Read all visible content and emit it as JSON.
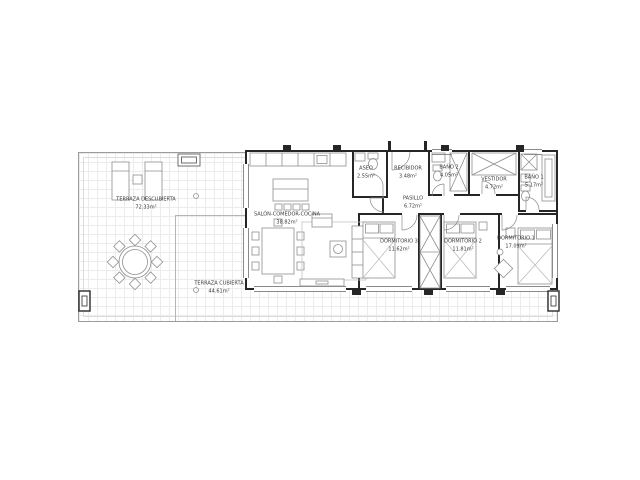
{
  "floor_plan": {
    "type": "architectural-floor-plan",
    "language": "es",
    "rooms": {
      "terraza_descubierta": {
        "label": "TERRAZA DESCUBIERTA",
        "area": "72.33m²"
      },
      "terraza_cubierta": {
        "label": "TERRAZA CUBIERTA",
        "area": "44.61m²"
      },
      "salon": {
        "label": "SALÓN-COMEDOR-COCINA",
        "area": "38.82m²"
      },
      "aseo": {
        "label": "ASEO",
        "area": "2.55m²"
      },
      "recibidor": {
        "label": "RECIBIDOR",
        "area": "3.48m²"
      },
      "pasillo": {
        "label": "PASILLO",
        "area": "6.72m²"
      },
      "bano_2": {
        "label": "BAÑO 2",
        "area": "4.05m²"
      },
      "vestidor": {
        "label": "VESTIDOR",
        "area": "4.72m²"
      },
      "bano_1": {
        "label": "BAÑO 1",
        "area": "5.17m²"
      },
      "dormitorio_3": {
        "label": "DORMITORIO 3",
        "area": "11.62m²"
      },
      "dormitorio_2": {
        "label": "DORMITORIO 2",
        "area": "11.81m²"
      },
      "dormitorio_1": {
        "label": "DORMITORIO 1",
        "area": "17.09m²"
      }
    },
    "colors": {
      "wall": "#262626",
      "furniture_line": "#8f8f8f",
      "grid": "#ececec",
      "terrace_border": "#9b9b9b",
      "text": "#3a3a3a",
      "background": "#ffffff"
    },
    "icons": {
      "bed-icon": "outlined rectangle with pillows and X blanket",
      "sofa-icon": "outlined rectangle with cushion lines",
      "dining-table-icon": "rectangle with 8 chairs",
      "round-table-icon": "circle with 8 diamond chairs",
      "kitchen-counter-icon": "segmented strip",
      "wardrobe-icon": "rectangle with X cross",
      "bathtub-icon": "double rectangle",
      "toilet-icon": "rect with ellipse bowl",
      "lounger-icon": "double rectangle with headrest line",
      "door-arc-icon": "quarter-circle swing",
      "column-icon": "black square with inner rect",
      "skylight-icon": "double rectangle",
      "drain-icon": "small circle"
    }
  }
}
